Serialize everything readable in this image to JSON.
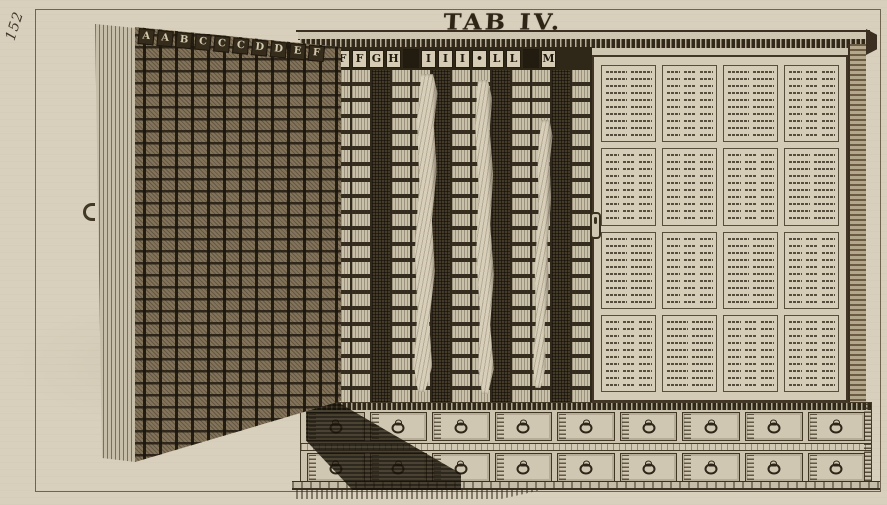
{
  "plate": {
    "title": "TAB IV.",
    "page_number": "152"
  },
  "colors": {
    "paper": "#d8d0bd",
    "ink_dark": "#33291b",
    "ink_mid": "#5d5038",
    "wood_light": "#d2c9b4",
    "door_dark": "#4a3f2c"
  },
  "cabinet": {
    "door": {
      "letters": [
        "A",
        "A",
        "B",
        "C",
        "C",
        "C",
        "D",
        "D",
        "E",
        "F"
      ]
    },
    "columns": {
      "header_groups": [
        [
          "F",
          "F",
          "G",
          "H"
        ],
        [
          "I",
          "I",
          "I",
          "•",
          "L",
          "L"
        ],
        [
          "M"
        ]
      ],
      "column_count": 13,
      "cloth_count": 3
    },
    "panel": {
      "rows": 4,
      "cols": 4,
      "subcolumns": [
        [
          2,
          3,
          2,
          3
        ],
        [
          3,
          3,
          3,
          2
        ],
        [
          2,
          3,
          2,
          3
        ],
        [
          3,
          2,
          3,
          3
        ]
      ]
    },
    "drawers": {
      "rows": 2,
      "per_row": 9
    }
  }
}
